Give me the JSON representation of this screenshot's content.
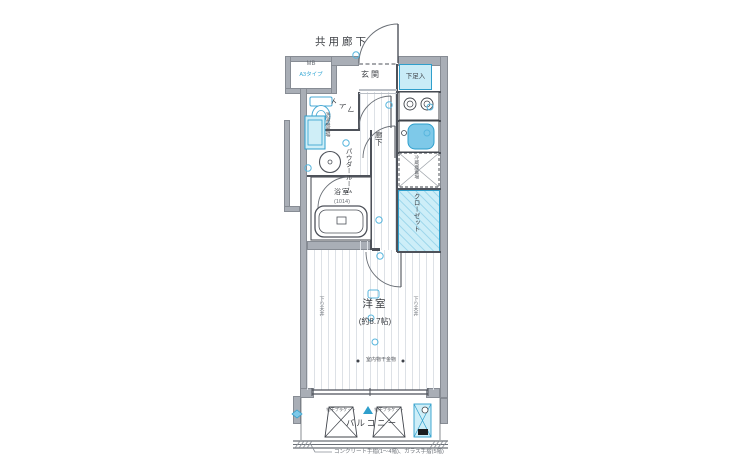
{
  "plan": {
    "corridor_label": "共用廊下",
    "mb_label": "MB",
    "mb_type": "A3タイプ",
    "entrance_label": "玄関",
    "shoe_label": "下足入",
    "toilet_label": "トイレ",
    "washer_label": "洗濯機置場",
    "powder_label": "パウダールーム",
    "hall_label": "廊下",
    "bath_label": "浴室",
    "bath_size": "(1014)",
    "fridge_label": "冷蔵庫置場",
    "closet_label": "クローゼット",
    "room_label": "洋室",
    "room_size": "(約8.7帖)",
    "ceiling_label": "下り天井",
    "laundry_hook_label": "室内物干金物",
    "balcony_label": "バルコニー",
    "bracket_label": "物干ブラケット",
    "railing_note": "コンクリート手摺(1〜4階)、ガラス手摺(5階)"
  },
  "colors": {
    "wall": "#a9aeb6",
    "highlight_fill": "#c9ecf7",
    "highlight_border": "#2f9fcc",
    "accent_blue": "#58b6de",
    "line": "#4e525a"
  }
}
